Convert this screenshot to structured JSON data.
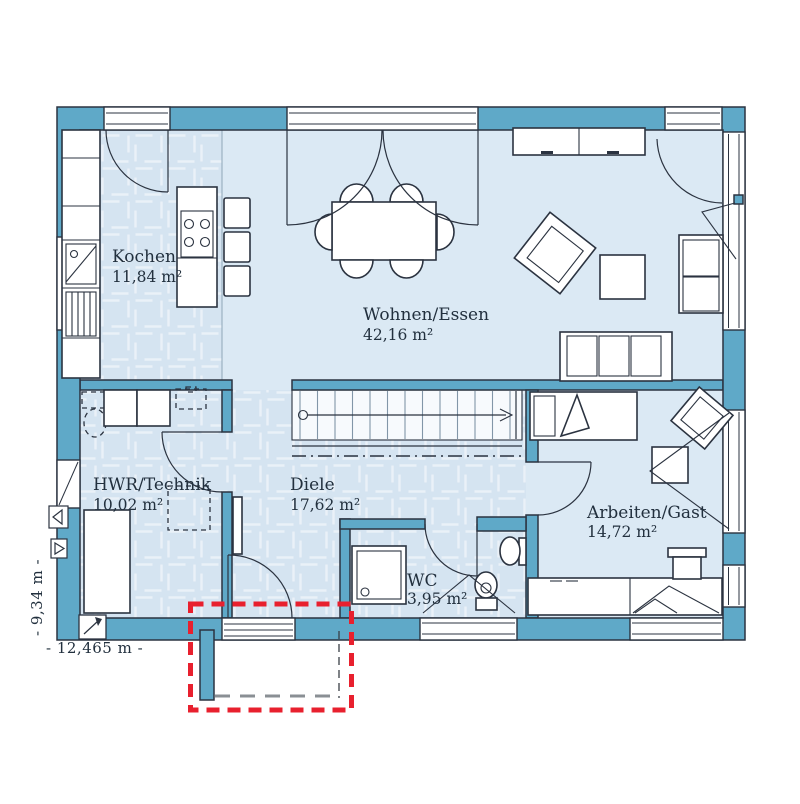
{
  "rooms": [
    {
      "name": "Kochen",
      "area": "11,84 m²"
    },
    {
      "name": "Wohnen/Essen",
      "area": "42,16 m²"
    },
    {
      "name": "HWR/Technik",
      "area": "10,02 m²"
    },
    {
      "name": "Diele",
      "area": "17,62 m²"
    },
    {
      "name": "WC",
      "area": "3,95 m²"
    },
    {
      "name": "Arbeiten/Gast",
      "area": "14,72 m²"
    }
  ],
  "dimensions": {
    "width_label": "- 12,465 m -",
    "height_label": "- 9,34 m -"
  },
  "colors": {
    "wall": "#5FA9C8",
    "floor": "#DBE9F4",
    "tile": "#D5E4F1",
    "tile_line": "#EAF1F8",
    "outline": "#2B3340",
    "text": "#22303E",
    "accent_red": "#E8202E",
    "canopy_gray": "#8A8F94"
  }
}
